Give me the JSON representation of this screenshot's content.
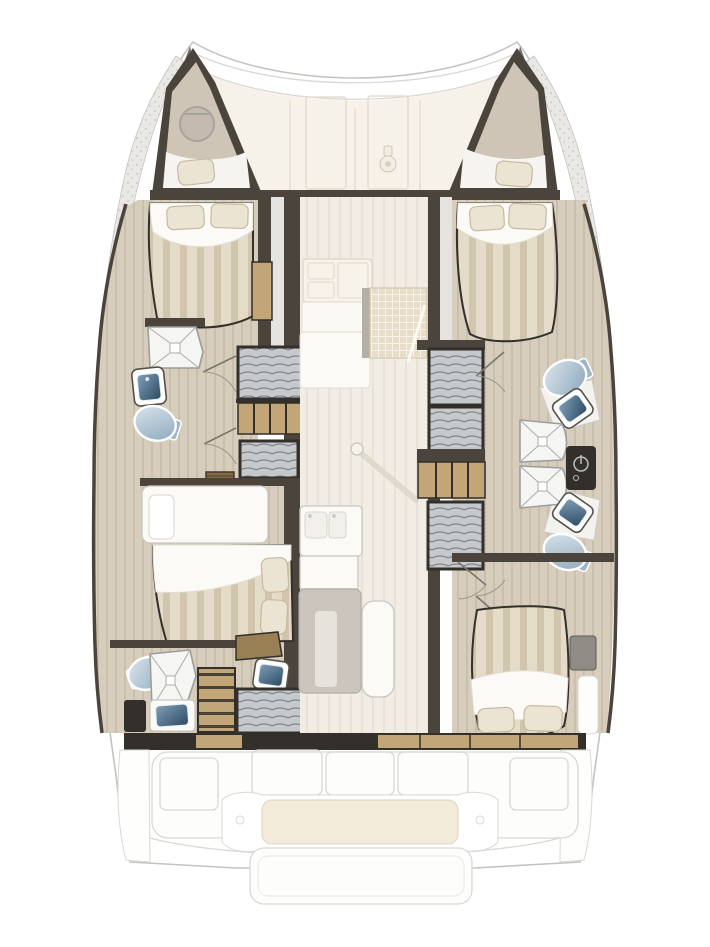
{
  "diagram": {
    "type": "floor-plan",
    "subject": "catamaran-interior-layout",
    "orientation": "bow-up"
  },
  "colors": {
    "background": "#ffffff",
    "boat-white": "#ffffff",
    "outline": "#c4c3c0",
    "outline-soft": "#d9d8d5",
    "deck": "#f6f2ea",
    "deck-line": "#e4ddce",
    "saloon-floor": "#f1ece4",
    "saloon-floor-line": "#e9e2d7",
    "wood-floor": "#d7cdbd",
    "wood-floor-line": "#cabfab",
    "wall-dark": "#4a443c",
    "wall-darker": "#332f2a",
    "mattress-a": "#e4dbc9",
    "mattress-b": "#d2c5ad",
    "sheet": "#fbfaf7",
    "pillow": "#ece4d3",
    "pillow-shade": "#c6b99f",
    "wood-furniture": "#c2a678",
    "wood-furniture-dark": "#997f54",
    "closet-base": "#c6c9cc",
    "closet-line": "#74787c",
    "shower-floor": "#f5f5f3",
    "shower-line": "#9d9d9b",
    "toilet-light": "#dde7ee",
    "toilet-dark": "#8aa6bb",
    "sink-light": "#7f9fb8",
    "sink-dark": "#2c4a63",
    "white-furniture": "#fbfaf7",
    "furniture-stroke": "#c9c6c0",
    "gray-table": "#cbc5bd",
    "cushion": "#f2ebd9",
    "mat": "#e8ddc8",
    "mat-line": "#f7f3e9",
    "speckle-base": "#e9e8e5",
    "speckle-dot": "#c9c8c4",
    "shadow": "#d8d1c5"
  },
  "sections": [
    {
      "name": "foredeck",
      "fixtures": [
        "deck-locker",
        "deck-locker",
        "windlass"
      ]
    },
    {
      "name": "port-bow-storage",
      "fixtures": [
        "bow-hatch",
        "cushion"
      ]
    },
    {
      "name": "starboard-bow-storage",
      "fixtures": [
        "cushion"
      ]
    },
    {
      "name": "port-forward-cabin",
      "fixtures": [
        "double-bed",
        "pillow",
        "pillow",
        "side-shelf"
      ]
    },
    {
      "name": "port-forward-bathroom",
      "fixtures": [
        "shower",
        "washbasin",
        "toilet",
        "hanging-locker",
        "shelf-unit",
        "hanging-locker",
        "door",
        "door"
      ]
    },
    {
      "name": "port-companionway",
      "fixtures": [
        "steps"
      ]
    },
    {
      "name": "port-aft-cabin",
      "fixtures": [
        "vanity-desk",
        "double-bed",
        "pillow",
        "pillow"
      ]
    },
    {
      "name": "port-aft-bathroom",
      "fixtures": [
        "toilet",
        "shower",
        "washbasin",
        "washbasin",
        "drawer-unit",
        "hanging-locker",
        "side-shelf"
      ]
    },
    {
      "name": "saloon",
      "fixtures": [
        "galley-stove",
        "galley-counter",
        "woven-mat",
        "mast-post",
        "galley-sink",
        "saloon-table",
        "bench-seat"
      ]
    },
    {
      "name": "starboard-forward-cabin",
      "fixtures": [
        "double-bed",
        "pillow",
        "pillow"
      ]
    },
    {
      "name": "starboard-forward-bathroom",
      "fixtures": [
        "toilet",
        "washbasin",
        "shower",
        "door"
      ]
    },
    {
      "name": "starboard-aft-bathroom",
      "fixtures": [
        "shower",
        "washbasin",
        "toilet",
        "door"
      ]
    },
    {
      "name": "starboard-wardrobe-wall",
      "fixtures": [
        "hanging-locker",
        "hanging-locker",
        "shelf-unit",
        "hanging-locker",
        "utility-panel"
      ]
    },
    {
      "name": "starboard-aft-cabin",
      "fixtures": [
        "double-bed",
        "pillow",
        "pillow",
        "side-shelf",
        "door"
      ]
    },
    {
      "name": "cockpit",
      "fixtures": [
        "bench-seat",
        "bench-seat",
        "bench-seat",
        "bench-seat",
        "bench-seat",
        "cockpit-table",
        "sunbed-cushion",
        "swim-platform"
      ]
    }
  ]
}
